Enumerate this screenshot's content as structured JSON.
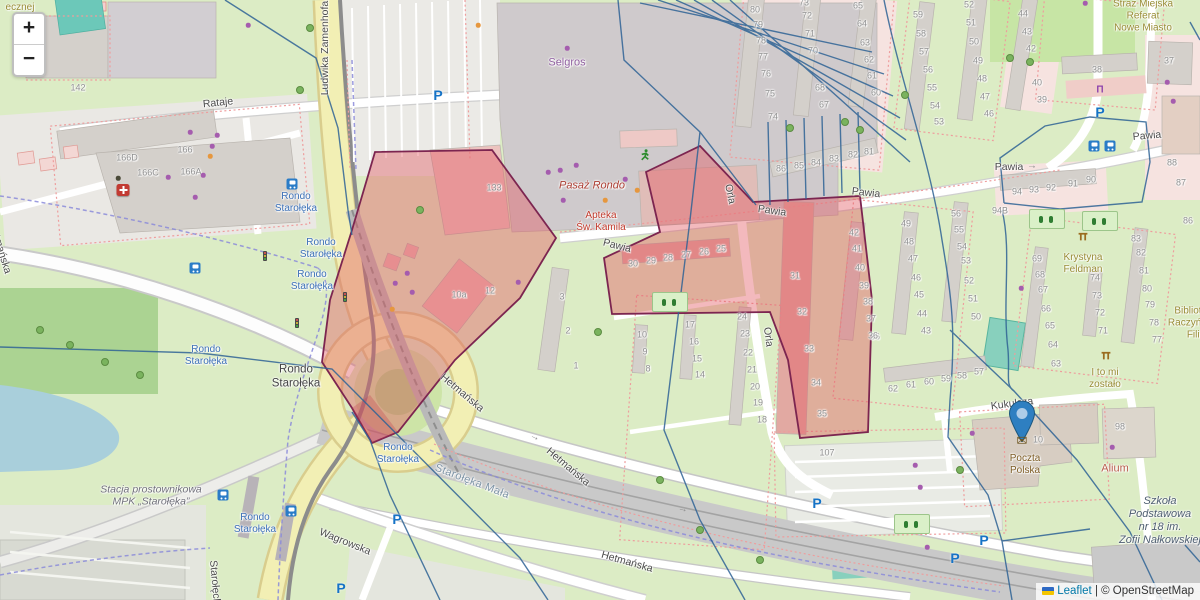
{
  "controls": {
    "zoom_in": "+",
    "zoom_out": "−"
  },
  "attribution": {
    "leaflet": "Leaflet",
    "separator": " | ",
    "osm": "© OpenStreetMap"
  },
  "street_labels": [
    [
      "Rataje",
      218,
      103,
      -6
    ],
    [
      "Ludwika Zamenhofa",
      325,
      48,
      -90
    ],
    [
      "Hetmańska",
      462,
      393,
      40
    ],
    [
      "Hetmańska",
      568,
      467,
      40
    ],
    [
      "Hetmańska",
      627,
      562,
      16
    ],
    [
      "Hetmańska",
      0,
      248,
      73
    ],
    [
      "Pawia",
      617,
      246,
      14
    ],
    [
      "Pawia",
      772,
      211,
      8
    ],
    [
      "Pawia",
      866,
      193,
      6
    ],
    [
      "Pawia",
      1009,
      167,
      0
    ],
    [
      "Pawia",
      1147,
      136,
      -5
    ],
    [
      "Orla",
      730,
      194,
      78
    ],
    [
      "Orla",
      768,
      337,
      82
    ],
    [
      "Kukułcza",
      1012,
      404,
      -7
    ],
    [
      "Wagrowska",
      345,
      542,
      22
    ],
    [
      "Starołęcka",
      215,
      585,
      85
    ]
  ],
  "transit_stops": {
    "text": [
      "Rondo",
      "Starołęka"
    ],
    "positions": [
      [
        296,
        203
      ],
      [
        321,
        249
      ],
      [
        312,
        281
      ],
      [
        206,
        356
      ],
      [
        398,
        454
      ],
      [
        255,
        524
      ]
    ]
  },
  "poi_labels": [
    {
      "lines": [
        "Selgros"
      ],
      "x": 567,
      "y": 63,
      "cls": "poi-purple"
    },
    {
      "lines": [
        "Pasaż Rondo"
      ],
      "x": 592,
      "y": 186,
      "cls": "poi-maroon-italic"
    },
    {
      "lines": [
        "Apteka",
        "Św. Kamila"
      ],
      "x": 601,
      "y": 222,
      "cls": "poi-red"
    },
    {
      "lines": [
        "Straż Miejska",
        "Referat",
        "Nowe Miasto"
      ],
      "x": 1143,
      "y": 16,
      "cls": "poi-olive"
    },
    {
      "lines": [
        "Krystyna",
        "Feldman"
      ],
      "x": 1083,
      "y": 264,
      "cls": "poi-olive"
    },
    {
      "lines": [
        "I to mi",
        "zostało"
      ],
      "x": 1105,
      "y": 379,
      "cls": "poi-olive"
    },
    {
      "lines": [
        "Biblioteka",
        "Raczyńskich",
        "Filia"
      ],
      "x": 1196,
      "y": 323,
      "cls": "poi-olive"
    },
    {
      "lines": [
        "ecznej"
      ],
      "x": 20,
      "y": 8,
      "cls": "poi-olive"
    },
    {
      "lines": [
        "Alium"
      ],
      "x": 1115,
      "y": 469,
      "cls": "poi-alium"
    },
    {
      "lines": [
        "Poczta",
        "Polska"
      ],
      "x": 1025,
      "y": 465,
      "cls": "poi-brown"
    },
    {
      "lines": [
        "Szkoła",
        "Podstawowa",
        "nr 18 im.",
        "Zofii Nałkowskiej"
      ],
      "x": 1160,
      "y": 521,
      "cls": "poi-school"
    },
    {
      "lines": [
        "Stacja prostownikowa",
        "MPK „Starołęka”"
      ],
      "x": 151,
      "y": 496,
      "cls": "poi-industrial"
    },
    {
      "lines": [
        "Starołęka Mała"
      ],
      "x": 472,
      "y": 482,
      "cls": "poi-locality",
      "rot": 21
    },
    {
      "lines": [
        "Rondo",
        "Starołęka"
      ],
      "x": 296,
      "y": 377,
      "cls": "poi-roundabout"
    }
  ],
  "house_numbers": [
    [
      "142",
      78,
      88
    ],
    [
      "166D",
      127,
      158
    ],
    [
      "166C",
      148,
      173
    ],
    [
      "166",
      185,
      150
    ],
    [
      "166A",
      191,
      172
    ],
    [
      "133",
      494,
      188
    ],
    [
      "10a",
      459,
      295
    ],
    [
      "12",
      490,
      291
    ],
    [
      "3",
      562,
      297
    ],
    [
      "2",
      568,
      331
    ],
    [
      "1",
      576,
      366
    ],
    [
      "80",
      755,
      10
    ],
    [
      "79",
      758,
      25
    ],
    [
      "78",
      761,
      41
    ],
    [
      "77",
      763,
      57
    ],
    [
      "76",
      766,
      74
    ],
    [
      "75",
      770,
      94
    ],
    [
      "74",
      773,
      117
    ],
    [
      "73",
      804,
      3
    ],
    [
      "72",
      807,
      16
    ],
    [
      "71",
      810,
      34
    ],
    [
      "70",
      813,
      51
    ],
    [
      "68",
      820,
      88
    ],
    [
      "67",
      824,
      105
    ],
    [
      "65",
      858,
      6
    ],
    [
      "64",
      862,
      24
    ],
    [
      "63",
      865,
      43
    ],
    [
      "62",
      869,
      60
    ],
    [
      "61",
      872,
      76
    ],
    [
      "60",
      876,
      93
    ],
    [
      "59",
      918,
      15
    ],
    [
      "58",
      921,
      34
    ],
    [
      "57",
      924,
      52
    ],
    [
      "56",
      928,
      70
    ],
    [
      "55",
      932,
      88
    ],
    [
      "54",
      935,
      106
    ],
    [
      "53",
      939,
      122
    ],
    [
      "52",
      969,
      5
    ],
    [
      "51",
      971,
      23
    ],
    [
      "50",
      974,
      42
    ],
    [
      "49",
      978,
      61
    ],
    [
      "48",
      982,
      79
    ],
    [
      "47",
      985,
      97
    ],
    [
      "46",
      989,
      114
    ],
    [
      "86",
      781,
      169
    ],
    [
      "85",
      799,
      166
    ],
    [
      "84",
      816,
      163
    ],
    [
      "83",
      834,
      159
    ],
    [
      "82",
      853,
      155
    ],
    [
      "81",
      869,
      152
    ],
    [
      "44",
      1023,
      14
    ],
    [
      "43",
      1027,
      32
    ],
    [
      "42",
      1031,
      49
    ],
    [
      "40",
      1037,
      83
    ],
    [
      "39",
      1042,
      100
    ],
    [
      "38",
      1097,
      70
    ],
    [
      "37",
      1169,
      61
    ],
    [
      "88",
      1172,
      163
    ],
    [
      "87",
      1181,
      183
    ],
    [
      "94",
      1017,
      192
    ],
    [
      "93",
      1034,
      190
    ],
    [
      "92",
      1051,
      188
    ],
    [
      "91",
      1073,
      184
    ],
    [
      "90",
      1091,
      180
    ],
    [
      "42",
      854,
      233
    ],
    [
      "41",
      857,
      249
    ],
    [
      "40",
      860,
      268
    ],
    [
      "39",
      864,
      286
    ],
    [
      "38",
      868,
      302
    ],
    [
      "37",
      871,
      319
    ],
    [
      "36",
      875,
      337
    ],
    [
      "49",
      906,
      224
    ],
    [
      "48",
      909,
      242
    ],
    [
      "47",
      913,
      259
    ],
    [
      "46",
      916,
      278
    ],
    [
      "45",
      919,
      295
    ],
    [
      "44",
      922,
      314
    ],
    [
      "43",
      926,
      331
    ],
    [
      "56",
      956,
      214
    ],
    [
      "55",
      959,
      230
    ],
    [
      "54",
      962,
      247
    ],
    [
      "53",
      966,
      261
    ],
    [
      "52",
      969,
      281
    ],
    [
      "51",
      973,
      299
    ],
    [
      "50",
      976,
      317
    ],
    [
      "62",
      893,
      389
    ],
    [
      "61",
      911,
      385
    ],
    [
      "60",
      929,
      382
    ],
    [
      "59",
      946,
      379
    ],
    [
      "58",
      962,
      376
    ],
    [
      "57",
      979,
      372
    ],
    [
      "94B",
      1000,
      211
    ],
    [
      "30",
      633,
      264
    ],
    [
      "29",
      651,
      261
    ],
    [
      "28",
      668,
      258
    ],
    [
      "27",
      686,
      255
    ],
    [
      "26",
      704,
      252
    ],
    [
      "25",
      721,
      249
    ],
    [
      "31",
      795,
      276
    ],
    [
      "32",
      802,
      312
    ],
    [
      "33",
      809,
      349
    ],
    [
      "34",
      816,
      383
    ],
    [
      "35",
      822,
      414
    ],
    [
      "24",
      742,
      317
    ],
    [
      "23",
      745,
      334
    ],
    [
      "22",
      748,
      353
    ],
    [
      "21",
      752,
      370
    ],
    [
      "20",
      755,
      387
    ],
    [
      "19",
      758,
      403
    ],
    [
      "18",
      762,
      420
    ],
    [
      "17",
      690,
      325
    ],
    [
      "16",
      694,
      342
    ],
    [
      "15",
      697,
      359
    ],
    [
      "14",
      700,
      375
    ],
    [
      "10",
      642,
      335
    ],
    [
      "9",
      645,
      352
    ],
    [
      "8",
      648,
      369
    ],
    [
      "69",
      1037,
      259
    ],
    [
      "68",
      1040,
      275
    ],
    [
      "67",
      1043,
      290
    ],
    [
      "66",
      1046,
      309
    ],
    [
      "65",
      1050,
      326
    ],
    [
      "64",
      1053,
      345
    ],
    [
      "63",
      1056,
      364
    ],
    [
      "74",
      1095,
      278
    ],
    [
      "73",
      1097,
      296
    ],
    [
      "72",
      1100,
      313
    ],
    [
      "71",
      1103,
      331
    ],
    [
      "83",
      1136,
      239
    ],
    [
      "82",
      1141,
      253
    ],
    [
      "81",
      1144,
      271
    ],
    [
      "80",
      1147,
      289
    ],
    [
      "79",
      1150,
      305
    ],
    [
      "78",
      1154,
      323
    ],
    [
      "77",
      1157,
      340
    ],
    [
      "86",
      1188,
      221
    ],
    [
      "36",
      873,
      336
    ],
    [
      "107",
      827,
      453
    ],
    [
      "98",
      1120,
      427
    ],
    [
      "10",
      1038,
      440
    ]
  ],
  "icons": [
    {
      "type": "marker-pin-icon",
      "x": 1022,
      "y": 424
    },
    {
      "type": "post-envelope-icon",
      "x": 1022,
      "y": 441
    },
    {
      "type": "parking-icon",
      "x": 438,
      "y": 95
    },
    {
      "type": "parking-icon",
      "x": 397,
      "y": 519
    },
    {
      "type": "parking-icon",
      "x": 341,
      "y": 588
    },
    {
      "type": "parking-icon",
      "x": 817,
      "y": 503
    },
    {
      "type": "parking-icon",
      "x": 955,
      "y": 558
    },
    {
      "type": "parking-icon",
      "x": 1100,
      "y": 112
    },
    {
      "type": "parking-icon",
      "x": 984,
      "y": 540
    },
    {
      "type": "bus-stop-icon",
      "x": 292,
      "y": 184
    },
    {
      "type": "bus-stop-icon",
      "x": 195,
      "y": 268
    },
    {
      "type": "bus-stop-icon",
      "x": 1094,
      "y": 146
    },
    {
      "type": "bus-stop-icon",
      "x": 1110,
      "y": 146
    },
    {
      "type": "bus-stop-icon",
      "x": 223,
      "y": 495
    },
    {
      "type": "bus-stop-icon",
      "x": 291,
      "y": 511
    },
    {
      "type": "hospital-icon",
      "x": 123,
      "y": 190
    },
    {
      "type": "bench-icon",
      "x": 1100,
      "y": 90
    },
    {
      "type": "runner-icon",
      "x": 645,
      "y": 158
    },
    {
      "type": "fitness-icon",
      "x": 1083,
      "y": 238
    },
    {
      "type": "fitness-icon",
      "x": 1106,
      "y": 357
    },
    {
      "type": "traffic-light-icon",
      "x": 265,
      "y": 256
    },
    {
      "type": "traffic-light-icon",
      "x": 345,
      "y": 297
    },
    {
      "type": "traffic-light-icon",
      "x": 297,
      "y": 323
    },
    {
      "type": "arrow-icon",
      "x": 1032,
      "y": 166,
      "rot": 0
    },
    {
      "type": "arrow-icon",
      "x": 535,
      "y": 437,
      "rot": 25
    },
    {
      "type": "arrow-icon",
      "x": 683,
      "y": 509,
      "rot": 14
    },
    {
      "type": "playground-icon",
      "x": 670,
      "y": 302
    },
    {
      "type": "playground-icon",
      "x": 912,
      "y": 524
    },
    {
      "type": "playground-icon",
      "x": 1047,
      "y": 219
    },
    {
      "type": "playground-icon",
      "x": 1100,
      "y": 221
    },
    {
      "type": "purple-dot-icon",
      "x": 567,
      "y": 48
    },
    {
      "type": "purple-dot-icon",
      "x": 548,
      "y": 172
    },
    {
      "type": "purple-dot-icon",
      "x": 560,
      "y": 170
    },
    {
      "type": "purple-dot-icon",
      "x": 576,
      "y": 165
    },
    {
      "type": "purple-dot-icon",
      "x": 625,
      "y": 179
    },
    {
      "type": "purple-dot-icon",
      "x": 563,
      "y": 200
    },
    {
      "type": "purple-dot-icon",
      "x": 190,
      "y": 132
    },
    {
      "type": "purple-dot-icon",
      "x": 217,
      "y": 135
    },
    {
      "type": "purple-dot-icon",
      "x": 212,
      "y": 146
    },
    {
      "type": "purple-dot-icon",
      "x": 168,
      "y": 177
    },
    {
      "type": "purple-dot-icon",
      "x": 203,
      "y": 175
    },
    {
      "type": "purple-dot-icon",
      "x": 195,
      "y": 197
    },
    {
      "type": "purple-dot-icon",
      "x": 248,
      "y": 25
    },
    {
      "type": "purple-dot-icon",
      "x": 395,
      "y": 283
    },
    {
      "type": "purple-dot-icon",
      "x": 407,
      "y": 273
    },
    {
      "type": "purple-dot-icon",
      "x": 412,
      "y": 292
    },
    {
      "type": "purple-dot-icon",
      "x": 518,
      "y": 282
    },
    {
      "type": "purple-dot-icon",
      "x": 1085,
      "y": 3
    },
    {
      "type": "purple-dot-icon",
      "x": 1167,
      "y": 82
    },
    {
      "type": "purple-dot-icon",
      "x": 1173,
      "y": 101
    },
    {
      "type": "purple-dot-icon",
      "x": 1021,
      "y": 288
    },
    {
      "type": "purple-dot-icon",
      "x": 972,
      "y": 433
    },
    {
      "type": "purple-dot-icon",
      "x": 1112,
      "y": 447
    },
    {
      "type": "purple-dot-icon",
      "x": 915,
      "y": 465
    },
    {
      "type": "purple-dot-icon",
      "x": 920,
      "y": 487
    },
    {
      "type": "purple-dot-icon",
      "x": 927,
      "y": 547
    },
    {
      "type": "orange-dot-icon",
      "x": 478,
      "y": 25
    },
    {
      "type": "orange-dot-icon",
      "x": 605,
      "y": 200
    },
    {
      "type": "orange-dot-icon",
      "x": 637,
      "y": 190
    },
    {
      "type": "orange-dot-icon",
      "x": 210,
      "y": 156
    },
    {
      "type": "orange-dot-icon",
      "x": 392,
      "y": 309
    },
    {
      "type": "black-dot-icon",
      "x": 118,
      "y": 178
    },
    {
      "type": "tree-icon",
      "x": 310,
      "y": 28
    },
    {
      "type": "tree-icon",
      "x": 300,
      "y": 90
    },
    {
      "type": "tree-icon",
      "x": 598,
      "y": 332
    },
    {
      "type": "tree-icon",
      "x": 1010,
      "y": 58
    },
    {
      "type": "tree-icon",
      "x": 1030,
      "y": 62
    },
    {
      "type": "tree-icon",
      "x": 70,
      "y": 345
    },
    {
      "type": "tree-icon",
      "x": 105,
      "y": 362
    },
    {
      "type": "tree-icon",
      "x": 40,
      "y": 330
    },
    {
      "type": "tree-icon",
      "x": 140,
      "y": 375
    },
    {
      "type": "tree-icon",
      "x": 905,
      "y": 95
    },
    {
      "type": "tree-icon",
      "x": 860,
      "y": 130
    },
    {
      "type": "tree-icon",
      "x": 420,
      "y": 210
    },
    {
      "type": "tree-icon",
      "x": 790,
      "y": 128
    },
    {
      "type": "tree-icon",
      "x": 845,
      "y": 122
    },
    {
      "type": "tree-icon",
      "x": 960,
      "y": 470
    },
    {
      "type": "tree-icon",
      "x": 660,
      "y": 480
    },
    {
      "type": "tree-icon",
      "x": 700,
      "y": 530
    },
    {
      "type": "tree-icon",
      "x": 760,
      "y": 560
    }
  ]
}
